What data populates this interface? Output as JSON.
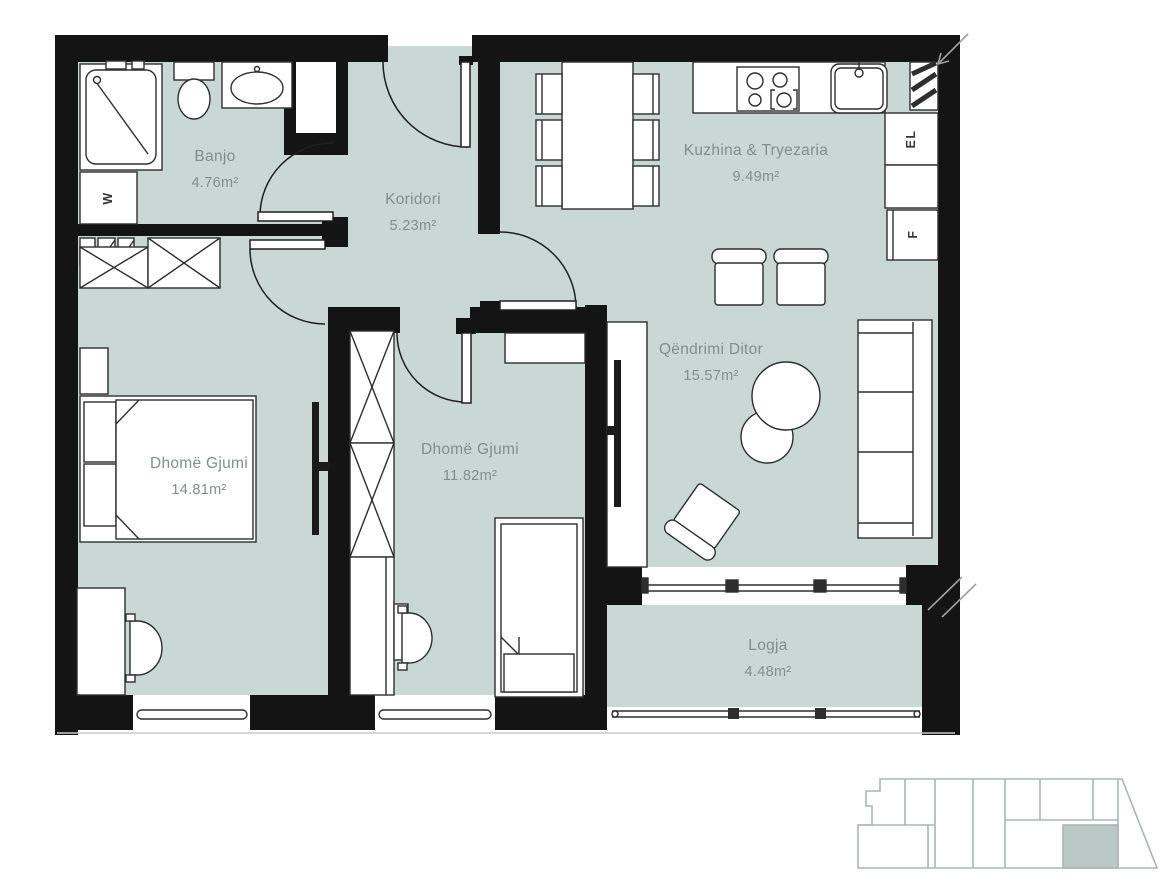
{
  "plan": {
    "type": "apartment-floor-plan",
    "colors": {
      "floor": "#c9d8d4",
      "wall": "#141414",
      "furniture_outline": "#2e2e2e",
      "room_label": "#7e8f8c",
      "key_outline": "#a9b6b4",
      "key_highlight": "#b9cac6"
    },
    "rooms": [
      {
        "name": "Banjo",
        "area": "4.76m²"
      },
      {
        "name": "Koridori",
        "area": "5.23m²"
      },
      {
        "name": "Kuzhina & Tryezaria",
        "area": "9.49m²"
      },
      {
        "name": "Qëndrimi Ditor",
        "area": "15.57m²"
      },
      {
        "name": "Dhomë Gjumi",
        "area": "14.81m²"
      },
      {
        "name": "Dhomë Gjumi",
        "area": "11.82m²"
      },
      {
        "name": "Logja",
        "area": "4.48m²"
      }
    ],
    "fixtures": {
      "washer_label": "W",
      "electrical_label": "EL",
      "fridge_label": "F"
    }
  }
}
